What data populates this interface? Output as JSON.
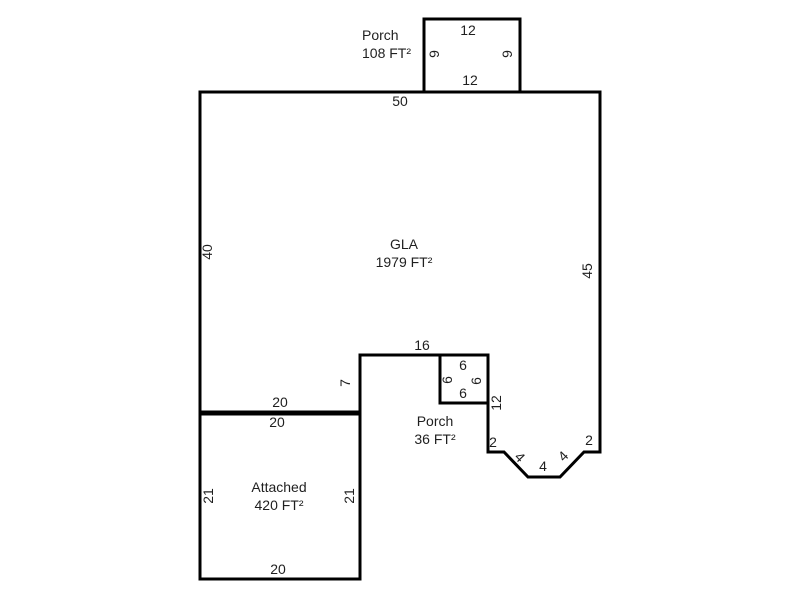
{
  "sketch": {
    "colors": {
      "wall": "#000000",
      "text": "#1f1f1f",
      "background": "#ffffff"
    },
    "porch_top": {
      "label_line1": "Porch",
      "label_line2": "108 FT²",
      "dim_top": "12",
      "dim_left": "9",
      "dim_right": "9",
      "dim_bottom": "12"
    },
    "gla": {
      "label_line1": "GLA",
      "label_line2": "1979 FT²",
      "dim_top": "50",
      "dim_left": "40",
      "dim_right": "45",
      "dim_notch_top": "16",
      "dim_notch_left": "7",
      "dim_notch_right": "12",
      "dim_bottom_left": "20",
      "dim_bay_left": "2",
      "dim_bay_right": "2",
      "dim_bay_diag_left": "4",
      "dim_bay_bottom": "4",
      "dim_bay_diag_right": "4"
    },
    "porch_small": {
      "label_line1": "Porch",
      "label_line2": "36 FT²",
      "dim_top": "6",
      "dim_left": "6",
      "dim_right": "6",
      "dim_bottom": "6"
    },
    "garage": {
      "label_line1": "Attached",
      "label_line2": "420 FT²",
      "dim_top_inner": "20",
      "dim_left": "21",
      "dim_right": "21",
      "dim_bottom": "20"
    }
  }
}
